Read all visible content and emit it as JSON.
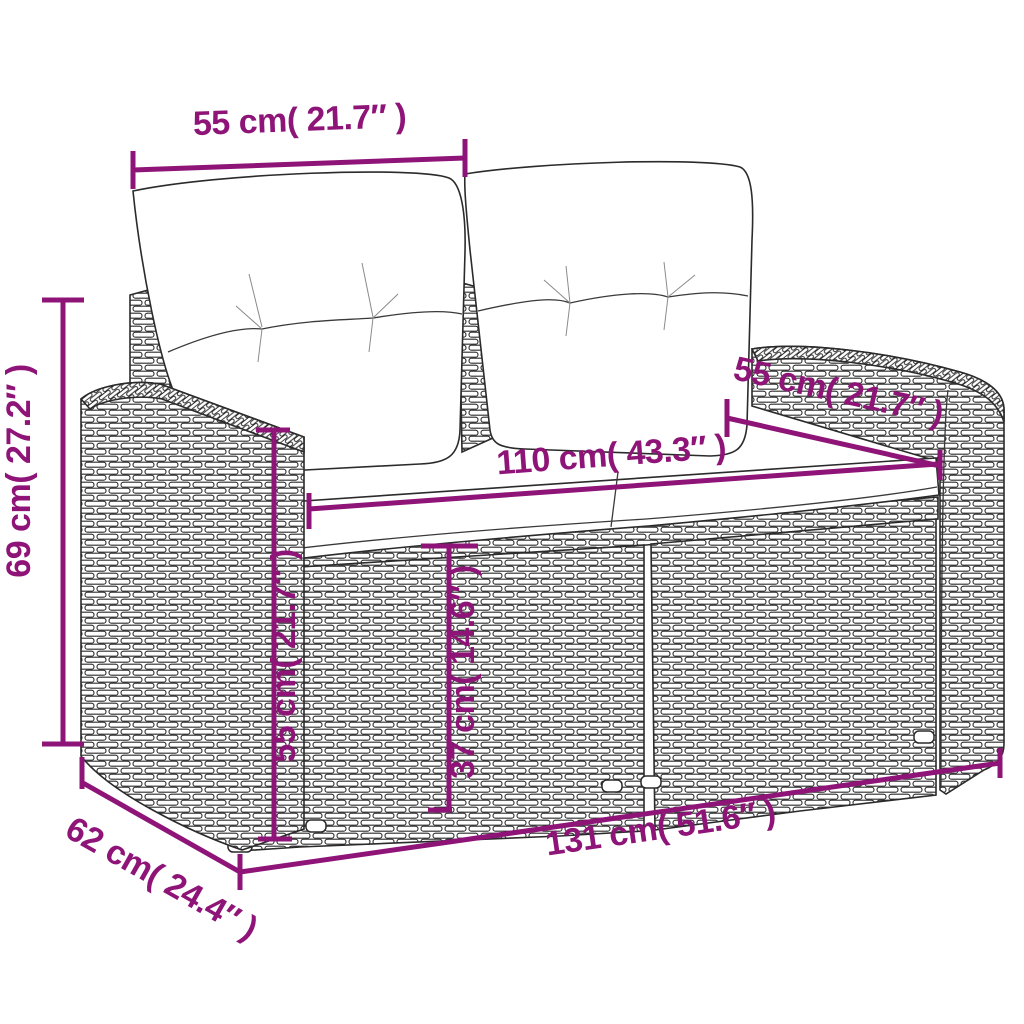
{
  "diagram": {
    "kind": "furniture-dimension-diagram",
    "subject": "poly rattan 2-seater garden sofa with white cushions",
    "colors": {
      "dimension_accent": "#8E1478",
      "line_art": "#2b2b2b",
      "background": "#ffffff",
      "cushion": "#ffffff"
    },
    "dimensions": [
      {
        "id": "back-cushion-width",
        "label": "55 cm( 21.7″ )",
        "cm": 55,
        "inches": 21.7,
        "orientation": "horizontal-top"
      },
      {
        "id": "overall-height",
        "label": "69 cm( 27.2″ )",
        "cm": 69,
        "inches": 27.2,
        "orientation": "vertical-left"
      },
      {
        "id": "side-depth",
        "label": "55 cm( 21.7″ )",
        "cm": 55,
        "inches": 21.7,
        "orientation": "diagonal-right"
      },
      {
        "id": "seat-width",
        "label": "110 cm( 43.3″ )",
        "cm": 110,
        "inches": 43.3,
        "orientation": "horizontal-middle"
      },
      {
        "id": "armrest-height",
        "label": "55 cm( 21.7″ )",
        "cm": 55,
        "inches": 21.7,
        "orientation": "vertical-inner-left"
      },
      {
        "id": "seat-height",
        "label": "37 cm( 14.6″ )",
        "cm": 37,
        "inches": 14.6,
        "orientation": "vertical-inner-right"
      },
      {
        "id": "overall-width",
        "label": "131 cm( 51.6″ )",
        "cm": 131,
        "inches": 51.6,
        "orientation": "horizontal-bottom"
      },
      {
        "id": "overall-depth",
        "label": "62 cm( 24.4″ )",
        "cm": 62,
        "inches": 24.4,
        "orientation": "diagonal-bottom-left"
      }
    ]
  }
}
